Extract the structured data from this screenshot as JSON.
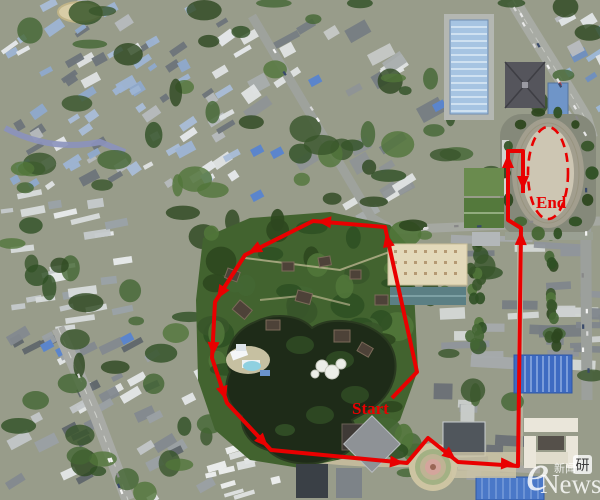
{
  "route_overlay": {
    "color": "#e90000",
    "start_label": "Start",
    "end_label": "End",
    "route_points": [
      [
        392,
        398
      ],
      [
        417,
        372
      ],
      [
        385,
        227
      ],
      [
        313,
        221
      ],
      [
        245,
        255
      ],
      [
        215,
        302
      ],
      [
        212,
        358
      ],
      [
        227,
        403
      ],
      [
        271,
        450
      ],
      [
        407,
        463
      ],
      [
        428,
        438
      ],
      [
        458,
        462
      ],
      [
        518,
        466
      ],
      [
        521,
        228
      ],
      [
        508,
        220
      ],
      [
        508,
        151
      ],
      [
        523,
        151
      ],
      [
        523,
        193
      ]
    ],
    "arrows": [
      {
        "x": 386,
        "y": 233,
        "deg": -102
      },
      {
        "x": 317,
        "y": 221,
        "deg": -175
      },
      {
        "x": 248,
        "y": 253,
        "deg": 153
      },
      {
        "x": 217,
        "y": 299,
        "deg": 122
      },
      {
        "x": 213,
        "y": 356,
        "deg": 92
      },
      {
        "x": 226,
        "y": 400,
        "deg": 72
      },
      {
        "x": 268,
        "y": 447,
        "deg": 47
      },
      {
        "x": 404,
        "y": 463,
        "deg": 6
      },
      {
        "x": 456,
        "y": 460,
        "deg": 39
      },
      {
        "x": 515,
        "y": 464,
        "deg": 2
      },
      {
        "x": 521,
        "y": 231,
        "deg": -89
      },
      {
        "x": 508,
        "y": 154,
        "deg": -90
      },
      {
        "x": 523,
        "y": 190,
        "deg": 90
      }
    ],
    "end_zone": {
      "cx": 548,
      "cy": 173,
      "rx": 20,
      "ry": 46
    }
  },
  "watermark": {
    "logo": "e",
    "cn": "新闻",
    "text": "News",
    "badge": "研"
  }
}
